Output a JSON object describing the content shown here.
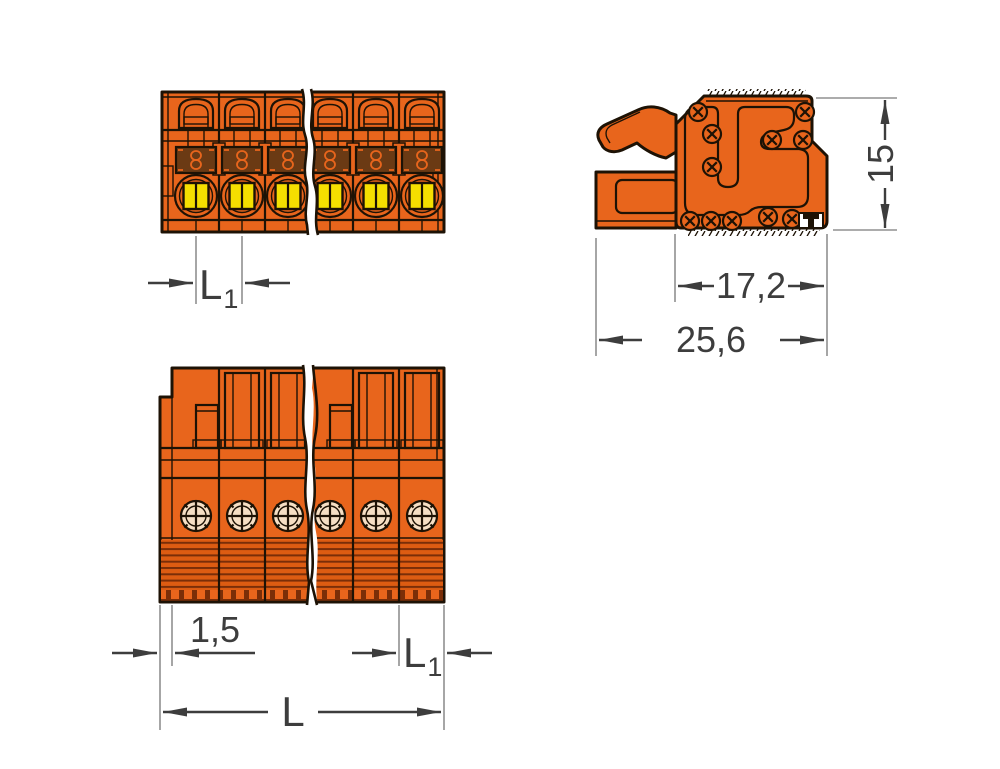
{
  "dimensions": {
    "l1_base": "L",
    "l1_sub": "1",
    "height": "15",
    "housing_depth": "17,2",
    "total_depth": "25,6",
    "end_wall": "1,5",
    "total_length": "L"
  },
  "colors": {
    "background": "#ffffff",
    "body_orange": "#e8651c",
    "body_orange_dark": "#dd5c12",
    "ribbed_dark": "#7a2e08",
    "button_yellow": "#f5df00",
    "actuator_brown": "#6b3a14",
    "funnel_cream": "#f6dfc4",
    "outline": "#1d1205",
    "dim_line": "#3d3d3d",
    "ext_line": "#909090"
  }
}
